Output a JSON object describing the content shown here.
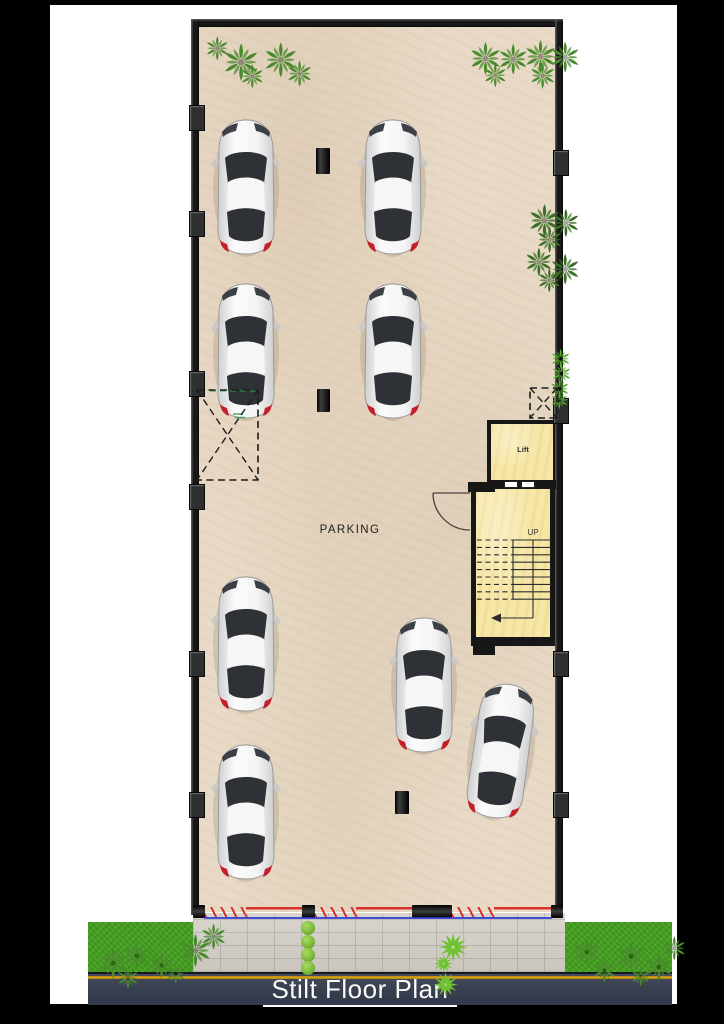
{
  "title": "Stilt Floor Plan",
  "labels": {
    "parking": "PARKING",
    "lift": "Lift",
    "up": "UP"
  },
  "colors": {
    "background": "#000000",
    "page": "#ffffff",
    "wall": "#171717",
    "floor": "#e8dac6",
    "room_yellow": "#f6e7a6",
    "paver": "#d6d2c9",
    "paver_joint": "#bab7af",
    "grass": "#44a120",
    "road": "#3a4150",
    "road_yellow": "#d8a61c",
    "barrier_red": "#d8302a",
    "barrier_blue": "#2a35d8",
    "palm_top": "#4a8a2e",
    "palm_inner": "#3a6e26",
    "palm_bright": "#57a92f",
    "bush": "#7cba3d",
    "agave": "#6fc231",
    "line_dark": "#2b2b2b",
    "title_color": "#fafafa",
    "parking_color": "#222222",
    "car_glass": "#2e3135",
    "car_tail": "#c4202c"
  },
  "cars": [
    {
      "x": 246,
      "y": 188,
      "rot": 0
    },
    {
      "x": 393,
      "y": 188,
      "rot": 0
    },
    {
      "x": 246,
      "y": 352,
      "rot": 0
    },
    {
      "x": 393,
      "y": 352,
      "rot": 0
    },
    {
      "x": 246,
      "y": 645,
      "rot": 0
    },
    {
      "x": 246,
      "y": 813,
      "rot": 0
    },
    {
      "x": 424,
      "y": 686,
      "rot": 0
    },
    {
      "x": 501,
      "y": 752,
      "rot": 8
    }
  ],
  "columns": [
    {
      "x": 316,
      "y": 148,
      "w": 14,
      "h": 26
    },
    {
      "x": 317,
      "y": 389,
      "w": 13,
      "h": 23
    },
    {
      "x": 395,
      "y": 791,
      "w": 14,
      "h": 23
    }
  ],
  "pilasters": {
    "left": [
      105,
      211,
      371,
      484,
      651,
      792
    ],
    "right": [
      150,
      398,
      651,
      792
    ]
  },
  "dashed_boxes": [
    {
      "x": 197,
      "y": 390,
      "w": 61,
      "h": 90
    },
    {
      "x": 530,
      "y": 388,
      "w": 27,
      "h": 30
    }
  ],
  "gates": {
    "posts": [
      {
        "x": 193,
        "w": 12
      },
      {
        "x": 302,
        "w": 13
      },
      {
        "x": 412,
        "w": 40
      },
      {
        "x": 551,
        "w": 12
      }
    ],
    "openings": [
      {
        "x": 205,
        "w": 97
      },
      {
        "x": 315,
        "w": 97
      },
      {
        "x": 452,
        "w": 99
      }
    ]
  },
  "stairs": {
    "x1": 477,
    "x2": 551,
    "split": 513,
    "y_top": 540,
    "step": 7.4,
    "count": 9,
    "mid_x": 533,
    "arrow_y": 618,
    "arrow_x": 500
  },
  "plants": {
    "palms_top": [
      [
        222,
        43,
        17
      ],
      [
        262,
        41,
        16
      ],
      [
        240,
        64,
        11
      ],
      [
        286,
        60,
        12
      ],
      [
        205,
        36,
        11
      ],
      [
        468,
        41,
        15
      ],
      [
        497,
        43,
        14
      ],
      [
        523,
        39,
        15
      ],
      [
        549,
        41,
        14
      ],
      [
        483,
        63,
        11
      ],
      [
        529,
        62,
        12
      ]
    ],
    "palms_inner": [
      [
        527,
        203,
        15
      ],
      [
        551,
        208,
        13
      ],
      [
        536,
        226,
        12
      ],
      [
        524,
        247,
        13
      ],
      [
        549,
        253,
        14
      ],
      [
        537,
        268,
        11
      ]
    ],
    "palms_strip": [
      [
        550,
        348,
        9
      ],
      [
        551,
        363,
        9
      ],
      [
        549,
        378,
        9
      ],
      [
        550,
        391,
        8
      ]
    ],
    "palms_grass": [
      [
        97,
        947,
        14
      ],
      [
        122,
        941,
        13
      ],
      [
        148,
        952,
        12
      ],
      [
        178,
        933,
        15
      ],
      [
        200,
        923,
        12
      ],
      [
        116,
        966,
        10
      ],
      [
        165,
        963,
        9
      ],
      [
        572,
        937,
        13
      ],
      [
        592,
        958,
        11
      ],
      [
        615,
        940,
        14
      ],
      [
        644,
        952,
        13
      ],
      [
        662,
        936,
        11
      ],
      [
        630,
        966,
        9
      ]
    ],
    "bushes": [
      [
        308,
        928
      ],
      [
        308,
        942
      ],
      [
        308,
        955
      ],
      [
        308,
        968
      ]
    ],
    "agaves": [
      [
        437,
        931,
        14
      ],
      [
        433,
        953,
        9
      ],
      [
        432,
        971,
        12
      ]
    ]
  }
}
